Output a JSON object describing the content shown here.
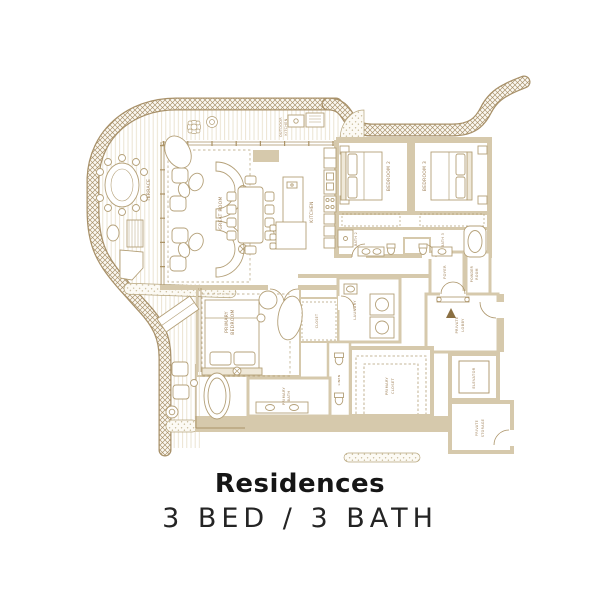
{
  "title": "Residences",
  "subtitle": "3 BED / 3 BATH",
  "plan": {
    "colors": {
      "accent_line": "#a8916a",
      "wall_fill": "#d6c9ac",
      "label_gold": "#a2845c",
      "title_dark": "#161616"
    },
    "rooms": {
      "terrace": [
        "TERRACE"
      ],
      "outdoor_kitchen": [
        "OUTDOOR",
        "KITCHEN"
      ],
      "great_room": [
        "GREAT ROOM"
      ],
      "kitchen": [
        "KITCHEN"
      ],
      "bedroom2": [
        "BEDROOM 2"
      ],
      "bedroom3": [
        "BEDROOM 3"
      ],
      "bath2": [
        "BATH 2"
      ],
      "bath3": [
        "BATH 3"
      ],
      "foyer": [
        "FOYER"
      ],
      "powder": [
        "POWDER",
        "ROOM"
      ],
      "laundry": [
        "LAUNDRY"
      ],
      "closet": [
        "CLOSET"
      ],
      "linen": [
        "LINEN"
      ],
      "private_lobby": [
        "PRIVATE",
        "LOBBY"
      ],
      "elevator": [
        "ELEVATOR"
      ],
      "private_storage": [
        "PRIVATE",
        "STORAGE"
      ],
      "primary_bedroom": [
        "PRIMARY",
        "BEDROOM"
      ],
      "primary_bath": [
        "PRIMARY",
        "BATH"
      ],
      "primary_closet": [
        "PRIMARY",
        "CLOSET"
      ]
    }
  }
}
